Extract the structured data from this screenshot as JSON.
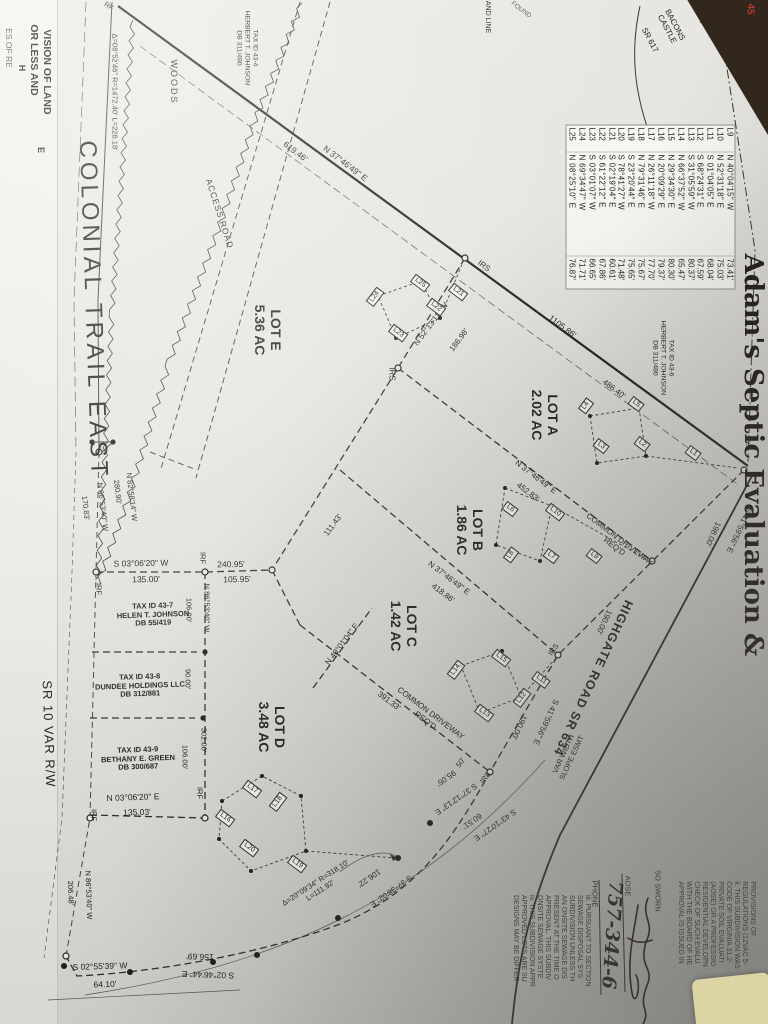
{
  "photo": {
    "background_color": "#32271d",
    "paper_color": "#e6e4de",
    "sticky_note_color": "#dcd4a2",
    "red_annotation": "45"
  },
  "labels": [
    {
      "name": "left-edge-fragment-1",
      "text": "VISION OF LAND",
      "x": 47,
      "y": 72,
      "rot": 90,
      "size": 10.5,
      "cls": "bold"
    },
    {
      "name": "left-edge-fragment-2",
      "text": "OR LESS AND",
      "x": 34,
      "y": 60,
      "rot": 90,
      "size": 10.5,
      "cls": "bold"
    },
    {
      "name": "left-edge-fragment-3",
      "text": "E",
      "x": 41,
      "y": 150,
      "rot": 90,
      "size": 9,
      "cls": "bold"
    },
    {
      "name": "left-ed极ge-fragment-4",
      "text": "H",
      "x": 22,
      "y": 68,
      "rot": 90,
      "size": 9,
      "cls": "bold"
    },
    {
      "name": "left-edge-fragment-5",
      "text": "ES OF RE",
      "x": 8,
      "y": 48,
      "rot": 90,
      "size": 8.5,
      "cls": "faint"
    },
    {
      "name": "marker-rf-top",
      "text": "RF",
      "x": 108,
      "y": 7,
      "rot": 37,
      "size": 7
    },
    {
      "name": "curve-data-top",
      "text": "Δ=08°52'46\" R=1472.40' L=228.18'",
      "x": 114,
      "y": 92,
      "rot": 90,
      "size": 7.5
    },
    {
      "name": "tax-parcel-43-4",
      "lines": [
        "TAX ID 43-4",
        "HERBERT T. JOHNSON",
        "DB 311/480"
      ],
      "x": 247,
      "y": 48,
      "rot": 90,
      "size": 6.8
    },
    {
      "name": "woods-label",
      "text": "WOODS",
      "x": 174,
      "y": 82,
      "rot": 90,
      "size": 9,
      "ls": 2
    },
    {
      "name": "access-road-label",
      "text": "ACCESS ROAD",
      "x": 219,
      "y": 214,
      "rot": 72,
      "size": 8.5,
      "ls": 1
    },
    {
      "name": "road-name-colonial-trail-east",
      "text": "COLONIAL TRAIL EAST",
      "x": 93,
      "y": 310,
      "rot": 88,
      "size": 24,
      "ls": 4
    },
    {
      "name": "dim-619",
      "text": "619.46'",
      "x": 295,
      "y": 152,
      "rot": 37,
      "size": 8.5
    },
    {
      "name": "bearing-3746-top",
      "text": "N 37°46'49\" E",
      "x": 345,
      "y": 164,
      "rot": 37,
      "size": 8.5
    },
    {
      "name": "fragment-and-line",
      "text": "AND LINE",
      "x": 487,
      "y": 17,
      "rot": 90,
      "size": 7
    },
    {
      "name": "fragment-found",
      "text": "FOUND",
      "x": 521,
      "y": 10,
      "rot": 37,
      "size": 6.5,
      "cls": "faint"
    },
    {
      "name": "road-name-bacons-castle",
      "lines": [
        "BACONS",
        "CASTLE"
      ],
      "x": 671,
      "y": 27,
      "rot": 62,
      "size": 8
    },
    {
      "name": "road-name-sr-617",
      "text": "SR 617",
      "x": 650,
      "y": 40,
      "rot": 62,
      "size": 8
    },
    {
      "name": "marker-ipf-top",
      "text": "IPF",
      "x": 724,
      "y": 22,
      "rot": 62,
      "size": 7
    },
    {
      "name": "adams-septic-overlay-text",
      "text": "Adam's Septic Evaluation &",
      "x": 752,
      "y": 455,
      "rot": 90,
      "size": 26,
      "cls": "serif"
    },
    {
      "name": "lot-e-label",
      "lines": [
        "LOT E",
        "5.36 AC"
      ],
      "x": 268,
      "y": 330,
      "rot": 90,
      "size": 14,
      "cls": "bold"
    },
    {
      "name": "lot-a-label",
      "lines": [
        "LOT A",
        "2.02 AC"
      ],
      "x": 545,
      "y": 415,
      "rot": 90,
      "size": 14,
      "cls": "bold"
    },
    {
      "name": "lot-b-label",
      "lines": [
        "LOT B",
        "1.86 AC"
      ],
      "x": 470,
      "y": 530,
      "rot": 90,
      "size": 14,
      "cls": "bold"
    },
    {
      "name": "lot-c-label",
      "lines": [
        "LOT C",
        "1.42 AC"
      ],
      "x": 404,
      "y": 626,
      "rot": 90,
      "size": 14,
      "cls": "bold"
    },
    {
      "name": "lot-d-label",
      "lines": [
        "LOT D",
        "3.48 AC"
      ],
      "x": 272,
      "y": 727,
      "rot": 90,
      "size": 14,
      "cls": "bold"
    },
    {
      "name": "tax-parcel-43-6",
      "lines": [
        "TAX ID 43-6",
        "HERBERT T. JOHNSON",
        "DB 311/480"
      ],
      "x": 663,
      "y": 358,
      "rot": 90,
      "size": 6.8
    },
    {
      "name": "dim-1105",
      "text": "1105.86'",
      "x": 562,
      "y": 327,
      "rot": 37,
      "size": 8.5
    },
    {
      "name": "dim-486",
      "text": "486.40'",
      "x": 614,
      "y": 389,
      "rot": 37,
      "size": 8
    },
    {
      "name": "marker-irs-1",
      "text": "IRS",
      "x": 392,
      "y": 374,
      "rot": 90,
      "size": 8
    },
    {
      "name": "marker-irs-2",
      "text": "IRS",
      "x": 484,
      "y": 266,
      "rot": 37,
      "size": 8
    },
    {
      "name": "bearing-5213",
      "text": "N 52°13'11\" W",
      "x": 431,
      "y": 324,
      "rot": -53,
      "size": 8
    },
    {
      "name": "dim-186",
      "text": "186.98'",
      "x": 459,
      "y": 340,
      "rot": -53,
      "size": 8
    },
    {
      "name": "bearing-3746-a",
      "text": "N 37°46'49\" E",
      "x": 536,
      "y": 477,
      "rot": 37,
      "size": 8
    },
    {
      "name": "dim-452",
      "text": "452.83'",
      "x": 528,
      "y": 492,
      "rot": 37,
      "size": 8
    },
    {
      "name": "common-driveway-1",
      "lines": [
        "COMMON DRIVEWAY",
        "REQ'D"
      ],
      "x": 617,
      "y": 543,
      "rot": 37,
      "size": 8
    },
    {
      "name": "bearing-3746-b",
      "text": "N 37°46'49\" E",
      "x": 449,
      "y": 578,
      "rot": 37,
      "size": 8
    },
    {
      "name": "dim-418",
      "text": "418.86'",
      "x": 443,
      "y": 593,
      "rot": 37,
      "size": 8
    },
    {
      "name": "common-driveway-2",
      "lines": [
        "COMMON DRIVEWAY",
        "REQ'D"
      ],
      "x": 428,
      "y": 717,
      "rot": 37,
      "size": 8
    },
    {
      "name": "dim-391",
      "text": "391.33'",
      "x": 389,
      "y": 701,
      "rot": 37,
      "size": 8
    },
    {
      "name": "bearing-4001",
      "text": "N 40°01'04\" E",
      "x": 342,
      "y": 644,
      "rot": -53,
      "size": 8
    },
    {
      "name": "dim-111",
      "text": "111.43'",
      "x": 333,
      "y": 525,
      "rot": -53,
      "size": 8
    },
    {
      "name": "bearing-8258",
      "text": "N 82°58'14\" W",
      "x": 131,
      "y": 497,
      "rot": 83,
      "size": 7.5
    },
    {
      "name": "dim-280",
      "text": "280.90'",
      "x": 117,
      "y": 492,
      "rot": 83,
      "size": 7.5
    },
    {
      "name": "bearing-8653-a",
      "text": "N 86°53'40\" W",
      "x": 102,
      "y": 507,
      "rot": 83,
      "size": 7.5
    },
    {
      "name": "dim-170",
      "text": "170.83'",
      "x": 85,
      "y": 508,
      "rot": 83,
      "size": 7.5
    },
    {
      "name": "bearing-0306-w",
      "text": "S 03°06'20\" W",
      "x": 141,
      "y": 564,
      "rot": -1,
      "size": 8.5
    },
    {
      "name": "dim-135a",
      "text": "135.00'",
      "x": 146,
      "y": 580,
      "rot": -1,
      "size": 8.5
    },
    {
      "name": "dim-240",
      "text": "240.95'",
      "x": 231,
      "y": 565,
      "rot": -1,
      "size": 8.5
    },
    {
      "name": "dim-105",
      "text": "105.95'",
      "x": 237,
      "y": 580,
      "rot": -1,
      "size": 8.5
    },
    {
      "name": "marker-irf-1",
      "text": "IRF",
      "x": 202,
      "y": 558,
      "rot": 90,
      "size": 7.5
    },
    {
      "name": "marker-irf-2",
      "text": "IRF",
      "x": 98,
      "y": 589,
      "rot": 90,
      "size": 7.5
    },
    {
      "name": "tax-parcel-43-7",
      "lines": [
        "TAX ID 43-7",
        "HELEN T. JOHNSON",
        "DB 55/419"
      ],
      "x": 153,
      "y": 615,
      "rot": -2,
      "size": 7.5,
      "cls": "bold"
    },
    {
      "name": "bearing-8653-b",
      "text": "N 86°53'40\" W",
      "x": 206,
      "y": 608,
      "rot": 90,
      "size": 7.5
    },
    {
      "name": "dim-106a",
      "text": "106.00'",
      "x": 188,
      "y": 610,
      "rot": 90,
      "size": 7.5
    },
    {
      "name": "tax-parcel-43-8",
      "lines": [
        "TAX ID 43-8",
        "DUNDEE HOLDINGS LLC",
        "DB 312/881"
      ],
      "x": 140,
      "y": 686,
      "rot": -2,
      "size": 7.5,
      "cls": "bold"
    },
    {
      "name": "dim-90",
      "text": "90.00'",
      "x": 187,
      "y": 679,
      "rot": 90,
      "size": 7.5
    },
    {
      "name": "dim-302",
      "text": "302.00'",
      "x": 203,
      "y": 740,
      "rot": 90,
      "size": 7.5
    },
    {
      "name": "dim-106b",
      "text": "106.00'",
      "x": 184,
      "y": 757,
      "rot": 90,
      "size": 7.5
    },
    {
      "name": "tax-parcel-43-9",
      "lines": [
        "TAX ID 43-9",
        "BETHANY E. GREEN",
        "DB 300/687"
      ],
      "x": 138,
      "y": 759,
      "rot": -2,
      "size": 7.5,
      "cls": "bold"
    },
    {
      "name": "bearing-0306-e",
      "text": "N 03°06'20\" E",
      "x": 133,
      "y": 798,
      "rot": -2,
      "size": 8.5
    },
    {
      "name": "dim-135b",
      "text": "135.03'",
      "x": 137,
      "y": 813,
      "rot": -2,
      "size": 8.5
    },
    {
      "name": "marker-irf-3",
      "text": "IRF",
      "x": 199,
      "y": 793,
      "rot": 90,
      "size": 7.5
    },
    {
      "name": "marker-irf-4",
      "text": "IRF",
      "x": 93,
      "y": 815,
      "rot": 90,
      "size": 7.5
    },
    {
      "name": "road-name-sr-10",
      "text": "SR 10 VAR R/W",
      "x": 48,
      "y": 734,
      "rot": 88,
      "size": 13,
      "ls": 1
    },
    {
      "name": "bearing-8653-c",
      "text": "N 86°53'40\" W",
      "x": 88,
      "y": 895,
      "rot": 88,
      "size": 7.5
    },
    {
      "name": "dim-206",
      "text": "206.48'",
      "x": 70,
      "y": 893,
      "rot": 88,
      "size": 7.5
    },
    {
      "name": "bearing-0255",
      "text": "S 02°55'39\" W",
      "x": 100,
      "y": 967,
      "rot": -2,
      "size": 8.5
    },
    {
      "name": "dim-64",
      "text": "64.10'",
      "x": 105,
      "y": 985,
      "rot": -2,
      "size": 8.5
    },
    {
      "name": "dim-156",
      "text": "156.69'",
      "x": 200,
      "y": 956,
      "rot": 182,
      "size": 8.5
    },
    {
      "name": "bearing-0246",
      "text": "S 02°46'44\" E",
      "x": 208,
      "y": 974,
      "rot": 182,
      "size": 8.5
    },
    {
      "name": "curve-data-bottom",
      "lines": [
        "Δ=20°09'34\" R=318.10'",
        "L=111.92'"
      ],
      "x": 318,
      "y": 887,
      "rot": -33,
      "size": 7.5
    },
    {
      "name": "bearing-3738",
      "text": "S 37°38'02\" E",
      "x": 391,
      "y": 891,
      "rot": 145,
      "size": 8
    },
    {
      "name": "dim-106c",
      "text": "106.22'",
      "x": 369,
      "y": 878,
      "rot": 145,
      "size": 8
    },
    {
      "name": "bearing-3712",
      "text": "S 37°12'13\" E",
      "x": 456,
      "y": 799,
      "rot": 145,
      "size": 8
    },
    {
      "name": "dim-95",
      "text": "95.05'",
      "x": 446,
      "y": 778,
      "rot": 145,
      "size": 8
    },
    {
      "name": "bearing-4310",
      "text": "S 43°10'27\" E",
      "x": 495,
      "y": 825,
      "rot": 145,
      "size": 8
    },
    {
      "name": "dim-60",
      "text": "60.51'",
      "x": 472,
      "y": 821,
      "rot": 145,
      "size": 8
    },
    {
      "name": "dim-50",
      "text": "50'",
      "x": 461,
      "y": 763,
      "rot": -55,
      "size": 7.5
    },
    {
      "name": "marker-irs-3",
      "text": "IRS",
      "x": 486,
      "y": 778,
      "rot": -55,
      "size": 7.5
    },
    {
      "name": "marker-irs-4",
      "text": "IRS",
      "x": 554,
      "y": 650,
      "rot": -55,
      "size": 7.5
    },
    {
      "name": "bearing-4159-a",
      "text": "S 41°59'56\" E",
      "x": 546,
      "y": 722,
      "rot": 115,
      "size": 8
    },
    {
      "name": "dim-190a",
      "text": "190.00'",
      "x": 519,
      "y": 727,
      "rot": 115,
      "size": 8
    },
    {
      "name": "road-name-highgate",
      "text": "HIGHGATE ROAD SR 634",
      "x": 593,
      "y": 678,
      "rot": 115,
      "size": 12.5,
      "cls": "bold",
      "ls": 1
    },
    {
      "name": "slope-easement-label",
      "lines": [
        "VAR WIDTH",
        "SLOPE ESMT"
      ],
      "x": 568,
      "y": 756,
      "rot": -65,
      "size": 7.5
    },
    {
      "name": "dim-190b",
      "text": "190.00'",
      "x": 604,
      "y": 622,
      "rot": 115,
      "size": 8
    },
    {
      "name": "bearing-4159-b",
      "text": "S 41°59'56\" E",
      "x": 739,
      "y": 530,
      "rot": 115,
      "size": 8
    },
    {
      "name": "dim-198",
      "text": "198.00'",
      "x": 713,
      "y": 534,
      "rot": 115,
      "size": 8
    },
    {
      "name": "marker-ipf-2",
      "text": "IPF",
      "x": 747,
      "y": 440,
      "rot": 115,
      "size": 7
    },
    {
      "name": "affidavit-so-sworn",
      "text": "SO SWORN",
      "x": 657,
      "y": 891,
      "rot": 90,
      "size": 7.5
    },
    {
      "name": "affidavit-aose-label",
      "text": "AOSE",
      "x": 627,
      "y": 886,
      "rot": 90,
      "size": 7.5
    },
    {
      "name": "affidavit-phone-label",
      "text": "PHONE",
      "x": 594,
      "y": 894,
      "rot": 90,
      "size": 7.5
    },
    {
      "name": "affidavit-phone-number",
      "text": "757-344-6",
      "x": 611,
      "y": 935,
      "rot": 94,
      "size": 19,
      "cls": "hand"
    },
    {
      "name": "notes-block-ii",
      "lines": [
        "PROVISIONS OF",
        "REGULATIONS (12VAC 5-",
        "ii. THIS SUBDIVISION WAS",
        "CODE OF VIRGINIA 31.2-",
        "PRIVATE SOIL EVALUATI",
        "(AOSE) OR A PROFESSIO",
        "RESIDENTIAL DEVELOPN",
        "CHECK OF SUCH EVALU",
        "WITH THE BOARD OF HE",
        "APPROVAL IS ISSUED IN"
      ],
      "x": 716,
      "y": 925,
      "rot": 90,
      "size": 7,
      "cls": "note"
    },
    {
      "name": "notes-block-iii",
      "lines": [
        "iii. PURSUANT TO SECTION",
        "SEWAGE DISPOSAL SYS",
        "SUBDIVISION UNLESS TH",
        "AN ONSITE SEWAGE DIS",
        "PRESENT AT THE TIME O",
        "APPROVAL. THIS SUBDIV",
        "ONSITE SEWAGE SYSTE",
        "iv. THIS SUBDIVISION APPR",
        "APPROVED LOTS ARE SU",
        "DESIGNS MAY BE DIFFER"
      ],
      "x": 551,
      "y": 941,
      "rot": 90,
      "size": 7,
      "cls": "note"
    },
    {
      "name": "red-annotation-45",
      "text": "45",
      "x": 750,
      "y": 9,
      "rot": 95,
      "size": 10,
      "cls": "red",
      "layer": "overlay"
    }
  ],
  "lot_line_boxes": [
    {
      "text": "L21",
      "x": 458,
      "y": 292,
      "rot": 37
    },
    {
      "text": "L22",
      "x": 436,
      "y": 307,
      "rot": 37
    },
    {
      "text": "L23",
      "x": 398,
      "y": 333,
      "rot": 37
    },
    {
      "text": "L24",
      "x": 375,
      "y": 297,
      "rot": -53
    },
    {
      "text": "L25",
      "x": 420,
      "y": 283,
      "rot": 37
    },
    {
      "text": "L1",
      "x": 693,
      "y": 453,
      "rot": 37
    },
    {
      "text": "L2",
      "x": 642,
      "y": 444,
      "rot": 37
    },
    {
      "text": "L3",
      "x": 601,
      "y": 446,
      "rot": 37
    },
    {
      "text": "L4",
      "x": 586,
      "y": 406,
      "rot": -53
    },
    {
      "text": "L5",
      "x": 636,
      "y": 404,
      "rot": 37
    },
    {
      "text": "L6",
      "x": 510,
      "y": 509,
      "rot": 37
    },
    {
      "text": "L7",
      "x": 551,
      "y": 556,
      "rot": 37
    },
    {
      "text": "L8",
      "x": 511,
      "y": 555,
      "rot": -53
    },
    {
      "text": "L9",
      "x": 594,
      "y": 556,
      "rot": 37
    },
    {
      "text": "L10",
      "x": 555,
      "y": 512,
      "rot": 37
    },
    {
      "text": "L11",
      "x": 541,
      "y": 680,
      "rot": 37
    },
    {
      "text": "L12",
      "x": 522,
      "y": 698,
      "rot": -53
    },
    {
      "text": "L13",
      "x": 484,
      "y": 713,
      "rot": 37
    },
    {
      "text": "L14",
      "x": 456,
      "y": 670,
      "rot": -53
    },
    {
      "text": "L15",
      "x": 501,
      "y": 658,
      "rot": 37
    },
    {
      "text": "L16",
      "x": 225,
      "y": 818,
      "rot": 37
    },
    {
      "text": "L17",
      "x": 252,
      "y": 789,
      "rot": 37
    },
    {
      "text": "L18",
      "x": 278,
      "y": 802,
      "rot": -53
    },
    {
      "text": "L19",
      "x": 297,
      "y": 864,
      "rot": 37
    },
    {
      "text": "L20",
      "x": 249,
      "y": 848,
      "rot": 37
    }
  ],
  "line_table": {
    "rows": [
      [
        "L9",
        "N 40°04'15\" W",
        "73.41'"
      ],
      [
        "L10",
        "N 52°31'18\" E",
        "75.03'"
      ],
      [
        "L11",
        "S 01°04'05\" E",
        "68.04'"
      ],
      [
        "L12",
        "S 68°24'31\" E",
        "67.59'"
      ],
      [
        "L13",
        "S 31°05'59\" W",
        "80.37'"
      ],
      [
        "L14",
        "N 66°37'52\" W",
        "65.47'"
      ],
      [
        "L15",
        "N 29°34'30\" E",
        "80.30'"
      ],
      [
        "L16",
        "N 20°09'29\" E",
        "79.37'"
      ],
      [
        "L17",
        "N 26°11'18\" W",
        "77.70'"
      ],
      [
        "L18",
        "N 79°31'46\" E",
        "75.67'"
      ],
      [
        "L19",
        "S 23°20'44\" E",
        "75.65'"
      ],
      [
        "L20",
        "S 78°41'27\" W",
        "71.48'"
      ],
      [
        "L21",
        "S 02°19'04\" E",
        "60.61'"
      ],
      [
        "L22",
        "S 61°22'12\" E",
        "67.86'"
      ],
      [
        "L23",
        "S 03°01'07\" W",
        "66.65'"
      ],
      [
        "L24",
        "N 69°34'47\" W",
        "71.71'"
      ],
      [
        "L25",
        "N 08°25'10\" E",
        "76.87'"
      ]
    ]
  }
}
